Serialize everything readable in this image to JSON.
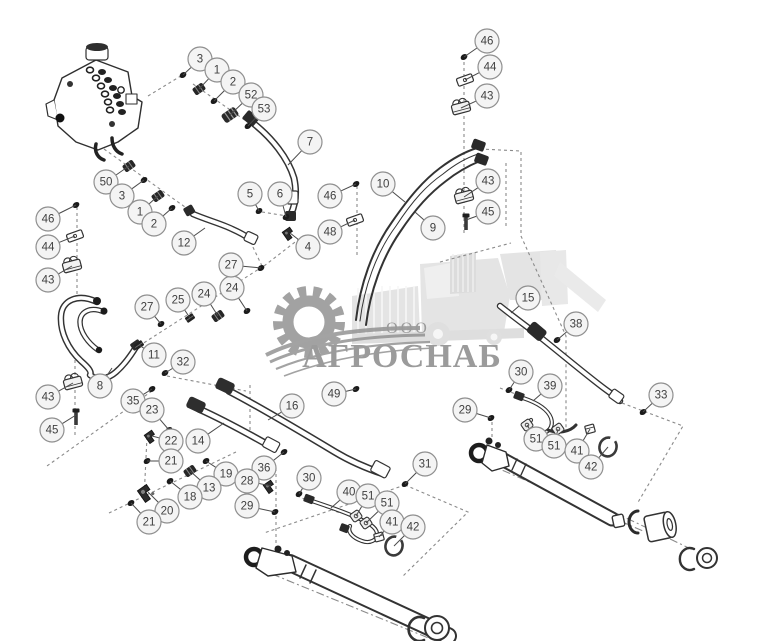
{
  "watermark": {
    "company_type": "ООО",
    "company_name": "АГРОСНАБ",
    "text_color": "#9a9a9a",
    "gear_color": "#8e8e8e",
    "machine_color": "#e4e4e4"
  },
  "diagram": {
    "background": "#ffffff",
    "line_color": "#2f2f2f",
    "dash_color": "#8a8a8a",
    "leader_color": "#4a4a4a",
    "callout_style": {
      "fill": "#f4f4f4",
      "stroke": "#8f8f8f",
      "text_color": "#3f3f3f",
      "radius": 12,
      "font_size": 11.5
    },
    "callouts": [
      {
        "label": "3",
        "x": 200,
        "y": 59,
        "tx": 183,
        "ty": 75,
        "part": "dot"
      },
      {
        "label": "1",
        "x": 217,
        "y": 70,
        "tx": 199,
        "ty": 89,
        "part": "rib"
      },
      {
        "label": "2",
        "x": 233,
        "y": 82,
        "tx": 214,
        "ty": 101,
        "part": "dot"
      },
      {
        "label": "52",
        "x": 251,
        "y": 95,
        "tx": 230,
        "ty": 115,
        "part": "riblg"
      },
      {
        "label": "53",
        "x": 264,
        "y": 109,
        "tx": 248,
        "ty": 126,
        "part": "dot"
      },
      {
        "label": "7",
        "x": 310,
        "y": 142,
        "tx": 288,
        "ty": 165,
        "part": "none"
      },
      {
        "label": "46",
        "x": 487,
        "y": 41,
        "tx": 464,
        "ty": 57,
        "part": "dot"
      },
      {
        "label": "44",
        "x": 490,
        "y": 67,
        "tx": 465,
        "ty": 80,
        "part": "plate",
        "rot": -20
      },
      {
        "label": "43",
        "x": 487,
        "y": 96,
        "tx": 461,
        "ty": 108,
        "part": "clamp",
        "rot": -15
      },
      {
        "label": "50",
        "x": 106,
        "y": 182,
        "tx": 129,
        "ty": 166,
        "part": "rib"
      },
      {
        "label": "3",
        "x": 122,
        "y": 196,
        "tx": 144,
        "ty": 180,
        "part": "dot"
      },
      {
        "label": "1",
        "x": 140,
        "y": 212,
        "tx": 158,
        "ty": 196,
        "part": "rib"
      },
      {
        "label": "2",
        "x": 154,
        "y": 224,
        "tx": 172,
        "ty": 208,
        "part": "dot"
      },
      {
        "label": "12",
        "x": 184,
        "y": 243,
        "tx": 205,
        "ty": 228,
        "part": "none"
      },
      {
        "label": "5",
        "x": 250,
        "y": 194,
        "tx": 259,
        "ty": 211,
        "part": "dot"
      },
      {
        "label": "6",
        "x": 280,
        "y": 194,
        "tx": 286,
        "ty": 217,
        "part": "dot"
      },
      {
        "label": "4",
        "x": 308,
        "y": 247,
        "tx": 290,
        "ty": 233,
        "part": "elbow"
      },
      {
        "label": "46",
        "x": 330,
        "y": 196,
        "tx": 356,
        "ty": 184,
        "part": "dot"
      },
      {
        "label": "48",
        "x": 330,
        "y": 232,
        "tx": 355,
        "ty": 220,
        "part": "plate",
        "rot": -20
      },
      {
        "label": "10",
        "x": 383,
        "y": 184,
        "tx": 405,
        "ty": 202,
        "part": "none"
      },
      {
        "label": "9",
        "x": 433,
        "y": 228,
        "tx": 415,
        "ty": 212,
        "part": "none"
      },
      {
        "label": "43",
        "x": 488,
        "y": 181,
        "tx": 464,
        "ty": 197,
        "part": "clamp",
        "rot": -15
      },
      {
        "label": "45",
        "x": 488,
        "y": 212,
        "tx": 466,
        "ty": 220,
        "part": "bolt",
        "rot": 0
      },
      {
        "label": "46",
        "x": 48,
        "y": 219,
        "tx": 76,
        "ty": 205,
        "part": "dot"
      },
      {
        "label": "44",
        "x": 48,
        "y": 247,
        "tx": 75,
        "ty": 236,
        "part": "plate",
        "rot": -20
      },
      {
        "label": "43",
        "x": 48,
        "y": 280,
        "tx": 72,
        "ty": 266,
        "part": "clamp",
        "rot": -15
      },
      {
        "label": "27",
        "x": 147,
        "y": 307,
        "tx": 161,
        "ty": 324,
        "part": "dot"
      },
      {
        "label": "25",
        "x": 178,
        "y": 300,
        "tx": 190,
        "ty": 318,
        "part": "nut"
      },
      {
        "label": "24",
        "x": 204,
        "y": 294,
        "tx": 218,
        "ty": 316,
        "part": "rib"
      },
      {
        "label": "24",
        "x": 232,
        "y": 288,
        "tx": 247,
        "ty": 311,
        "part": "dot"
      },
      {
        "label": "27",
        "x": 231,
        "y": 265,
        "tx": 261,
        "ty": 268,
        "part": "dot"
      },
      {
        "label": "11",
        "x": 154,
        "y": 355,
        "tx": 139,
        "ty": 345,
        "part": "nut"
      },
      {
        "label": "8",
        "x": 100,
        "y": 386,
        "tx": 112,
        "ty": 368,
        "part": "none"
      },
      {
        "label": "32",
        "x": 183,
        "y": 362,
        "tx": 165,
        "ty": 373,
        "part": "dot"
      },
      {
        "label": "43",
        "x": 48,
        "y": 397,
        "tx": 73,
        "ty": 383,
        "part": "clamp",
        "rot": -15
      },
      {
        "label": "45",
        "x": 52,
        "y": 430,
        "tx": 76,
        "ty": 415,
        "part": "bolt",
        "rot": 0
      },
      {
        "label": "35",
        "x": 133,
        "y": 401,
        "tx": 152,
        "ty": 389,
        "part": "dot"
      },
      {
        "label": "23",
        "x": 152,
        "y": 410,
        "tx": 169,
        "ty": 430,
        "part": "dot"
      },
      {
        "label": "22",
        "x": 171,
        "y": 441,
        "tx": 152,
        "ty": 436,
        "part": "elbow"
      },
      {
        "label": "21",
        "x": 171,
        "y": 461,
        "tx": 147,
        "ty": 461,
        "part": "dot"
      },
      {
        "label": "14",
        "x": 198,
        "y": 441,
        "tx": 224,
        "ty": 423,
        "part": "none"
      },
      {
        "label": "16",
        "x": 292,
        "y": 406,
        "tx": 268,
        "ty": 420,
        "part": "none"
      },
      {
        "label": "19",
        "x": 226,
        "y": 474,
        "tx": 206,
        "ty": 461,
        "part": "dot"
      },
      {
        "label": "13",
        "x": 209,
        "y": 488,
        "tx": 190,
        "ty": 471,
        "part": "rib"
      },
      {
        "label": "18",
        "x": 190,
        "y": 497,
        "tx": 170,
        "ty": 481,
        "part": "dot"
      },
      {
        "label": "20",
        "x": 167,
        "y": 511,
        "tx": 148,
        "ty": 492,
        "part": "elbowlg"
      },
      {
        "label": "21",
        "x": 149,
        "y": 522,
        "tx": 131,
        "ty": 503,
        "part": "dot"
      },
      {
        "label": "36",
        "x": 264,
        "y": 468,
        "tx": 284,
        "ty": 452,
        "part": "dot"
      },
      {
        "label": "28",
        "x": 247,
        "y": 481,
        "tx": 271,
        "ty": 486,
        "part": "elbow"
      },
      {
        "label": "29",
        "x": 247,
        "y": 506,
        "tx": 275,
        "ty": 512,
        "part": "dot"
      },
      {
        "label": "30",
        "x": 309,
        "y": 478,
        "tx": 299,
        "ty": 494,
        "part": "dot"
      },
      {
        "label": "40",
        "x": 349,
        "y": 492,
        "tx": 331,
        "ty": 508,
        "part": "none"
      },
      {
        "label": "51",
        "x": 368,
        "y": 496,
        "tx": 356,
        "ty": 516,
        "part": "clampsm"
      },
      {
        "label": "51",
        "x": 387,
        "y": 503,
        "tx": 366,
        "ty": 523,
        "part": "clampsm"
      },
      {
        "label": "41",
        "x": 392,
        "y": 522,
        "tx": 379,
        "ty": 537,
        "part": "cube",
        "rot": -15
      },
      {
        "label": "42",
        "x": 413,
        "y": 527,
        "tx": 394,
        "ty": 546,
        "part": "ring",
        "rot": 15
      },
      {
        "label": "49",
        "x": 334,
        "y": 394,
        "tx": 356,
        "ty": 389,
        "part": "dot"
      },
      {
        "label": "31",
        "x": 425,
        "y": 464,
        "tx": 405,
        "ty": 484,
        "part": "dot"
      },
      {
        "label": "29",
        "x": 465,
        "y": 410,
        "tx": 491,
        "ty": 418,
        "part": "dot"
      },
      {
        "label": "15",
        "x": 528,
        "y": 298,
        "tx": 511,
        "ty": 313,
        "part": "none"
      },
      {
        "label": "38",
        "x": 576,
        "y": 324,
        "tx": 557,
        "ty": 340,
        "part": "dot"
      },
      {
        "label": "30",
        "x": 521,
        "y": 372,
        "tx": 509,
        "ty": 390,
        "part": "dot"
      },
      {
        "label": "39",
        "x": 550,
        "y": 386,
        "tx": 533,
        "ty": 401,
        "part": "none"
      },
      {
        "label": "33",
        "x": 661,
        "y": 395,
        "tx": 643,
        "ty": 412,
        "part": "dot"
      },
      {
        "label": "51",
        "x": 536,
        "y": 439,
        "tx": 527,
        "ty": 425,
        "part": "clampsm"
      },
      {
        "label": "51",
        "x": 554,
        "y": 446,
        "tx": 558,
        "ty": 429,
        "part": "clampsm"
      },
      {
        "label": "41",
        "x": 577,
        "y": 451,
        "tx": 590,
        "ty": 429,
        "part": "cube",
        "rot": -15
      },
      {
        "label": "42",
        "x": 591,
        "y": 467,
        "tx": 608,
        "ty": 447,
        "part": "ring",
        "rot": 15
      }
    ]
  }
}
